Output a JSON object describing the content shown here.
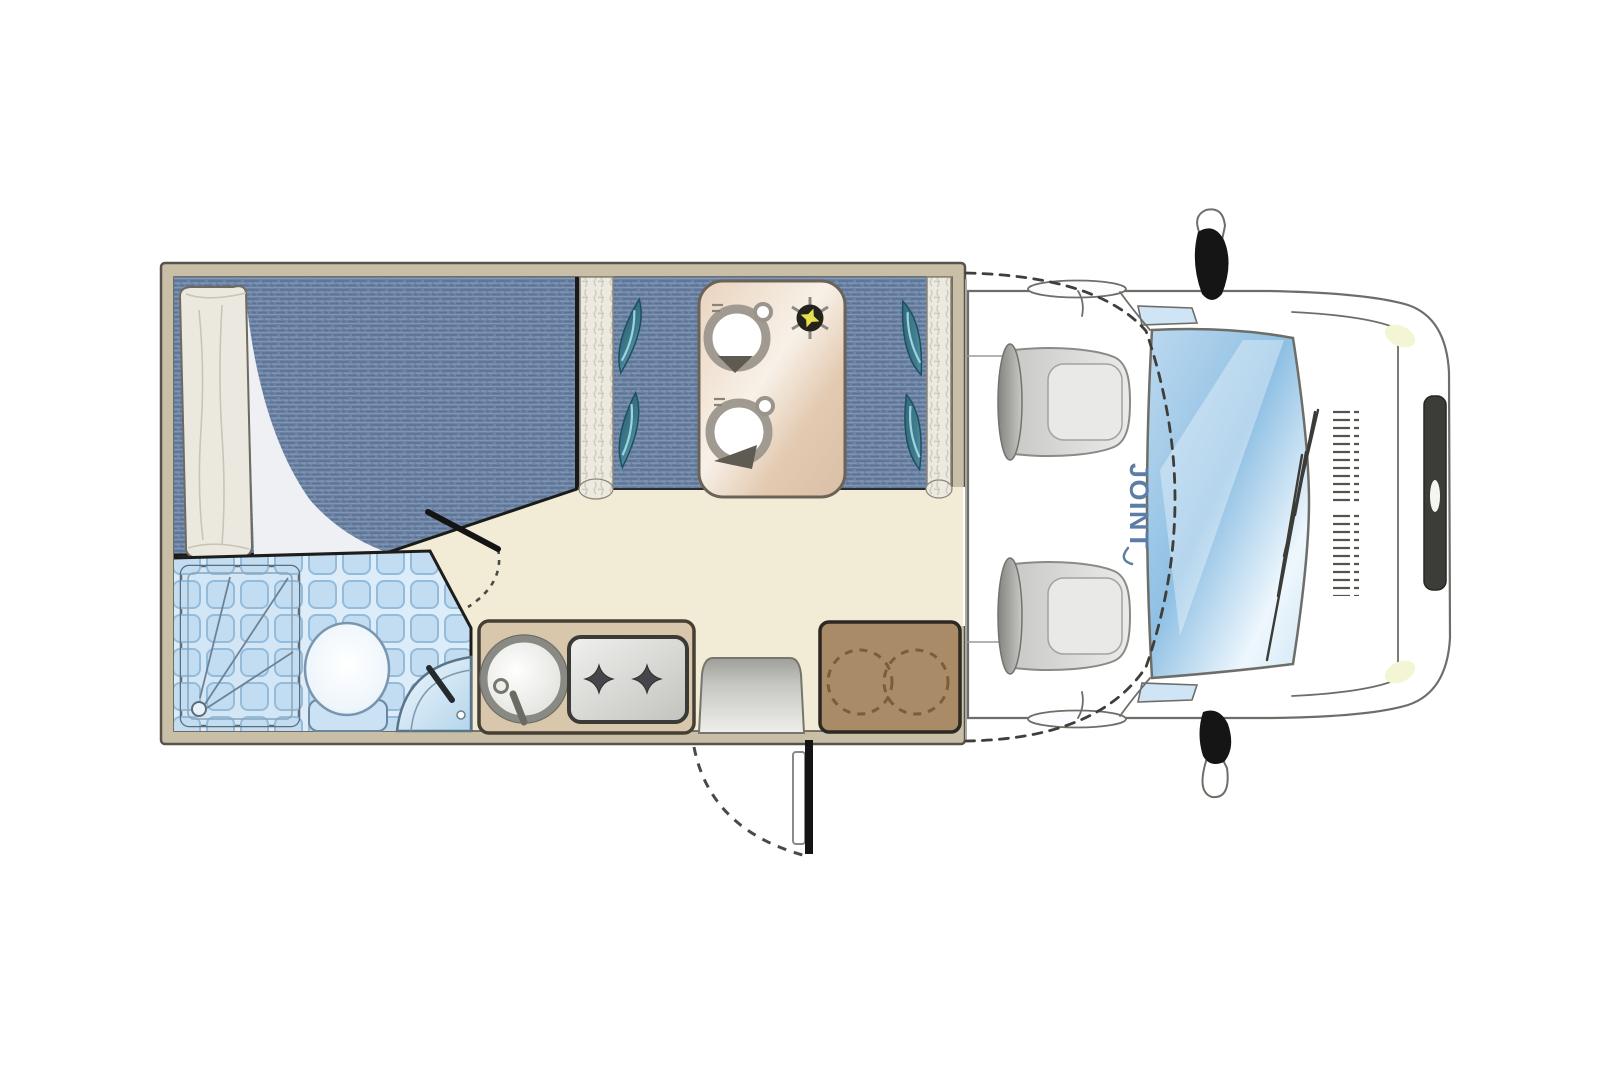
{
  "brand": {
    "label": "JOINT"
  },
  "colors": {
    "wall": "#c9bfa7",
    "floor": "#f2ecd6",
    "denim": "#6d84a4",
    "pillow": "#2e6a7c",
    "tile": "#c2ddf1",
    "tileline": "#93bbdb",
    "counter": "#d8c7ab",
    "cabinet": "#aa8b68",
    "step": "#bdbdb7",
    "star": "#e8df4e",
    "seat": "#dededc",
    "brand": "#5c7ea6",
    "ink": "#1b1b19"
  },
  "floorplan": {
    "fixtures": [
      "double-bed",
      "duvet-roll",
      "dinette-bench-left",
      "dinette-bench-right",
      "dinette-table",
      "table-lamp-star",
      "bathroom",
      "shower-tray",
      "toilet",
      "corner-washbasin",
      "kitchen-counter",
      "round-sink",
      "two-burner-hob",
      "entry-step",
      "entry-door",
      "storage-cabinet",
      "cab",
      "driver-seat",
      "passenger-seat",
      "windshield",
      "side-mirror-top",
      "side-mirror-bottom"
    ]
  }
}
